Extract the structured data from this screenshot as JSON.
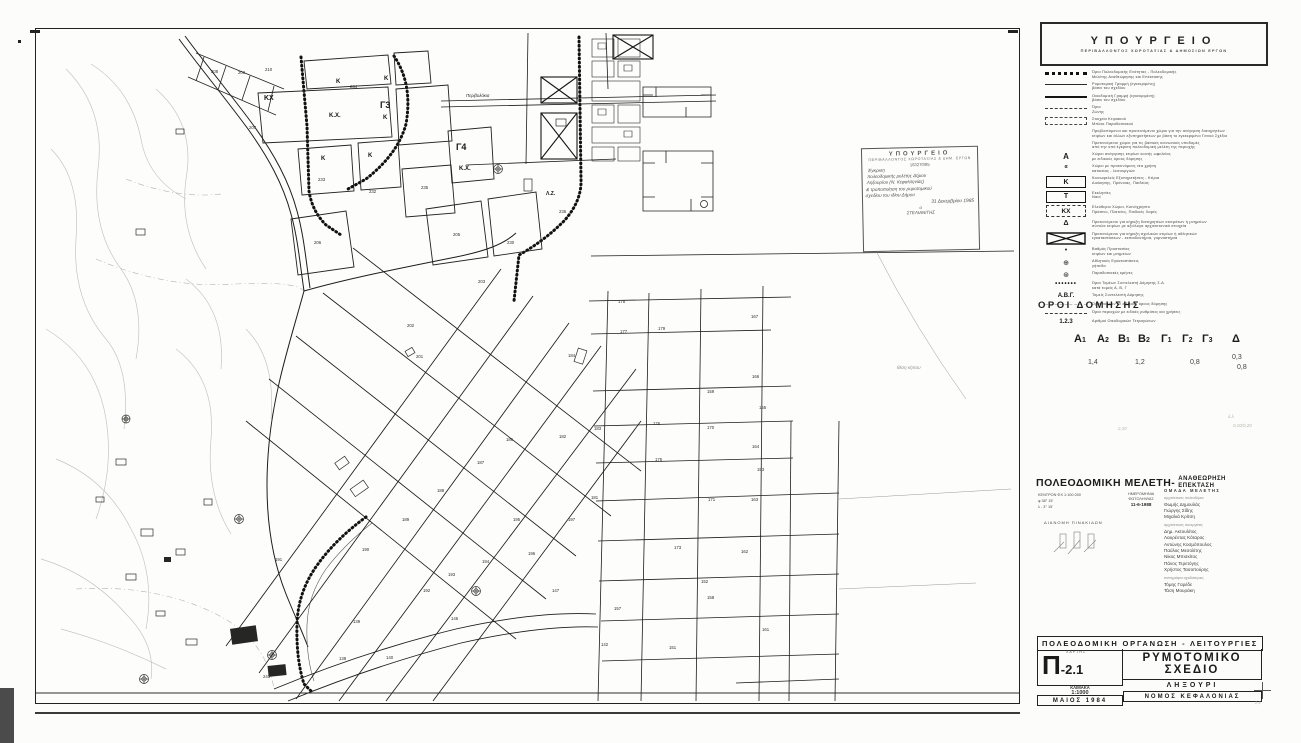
{
  "map": {
    "street_label": "Περιβολάκια",
    "zone_labels": [
      {
        "t": "Κ",
        "x": 300,
        "y": 54,
        "s": 6
      },
      {
        "t": "234",
        "x": 314,
        "y": 59,
        "s": 4.3,
        "n": 1
      },
      {
        "t": "Κ",
        "x": 348,
        "y": 51,
        "s": 6
      },
      {
        "t": "Κ.Χ.",
        "x": 293,
        "y": 88,
        "s": 6
      },
      {
        "t": "ΚΧ",
        "x": 228,
        "y": 71,
        "s": 7
      },
      {
        "t": "Γ3",
        "x": 344,
        "y": 79,
        "s": 9
      },
      {
        "t": "Κ",
        "x": 347,
        "y": 90,
        "s": 6
      },
      {
        "t": "Κ",
        "x": 285,
        "y": 131,
        "s": 6
      },
      {
        "t": "Κ",
        "x": 332,
        "y": 128,
        "s": 6
      },
      {
        "t": "Γ4",
        "x": 420,
        "y": 121,
        "s": 9
      },
      {
        "t": "Κ.Χ.",
        "x": 423,
        "y": 141,
        "s": 6
      },
      {
        "t": "Λ.Ζ.",
        "x": 510,
        "y": 166,
        "s": 5
      }
    ],
    "block_numbers": [
      {
        "n": "208",
        "x": 175,
        "y": 44
      },
      {
        "n": "209",
        "x": 202,
        "y": 45
      },
      {
        "n": "210",
        "x": 229,
        "y": 42
      },
      {
        "n": "207",
        "x": 213,
        "y": 100
      },
      {
        "n": "233",
        "x": 282,
        "y": 152
      },
      {
        "n": "232",
        "x": 333,
        "y": 164
      },
      {
        "n": "235",
        "x": 385,
        "y": 160
      },
      {
        "n": "236",
        "x": 523,
        "y": 184
      },
      {
        "n": "206",
        "x": 278,
        "y": 215
      },
      {
        "n": "205",
        "x": 417,
        "y": 207
      },
      {
        "n": "230",
        "x": 471,
        "y": 215
      },
      {
        "n": "203",
        "x": 442,
        "y": 254
      },
      {
        "n": "202",
        "x": 371,
        "y": 298
      },
      {
        "n": "201",
        "x": 380,
        "y": 329
      },
      {
        "n": "178",
        "x": 582,
        "y": 274
      },
      {
        "n": "177",
        "x": 584,
        "y": 304
      },
      {
        "n": "179",
        "x": 622,
        "y": 301
      },
      {
        "n": "167",
        "x": 715,
        "y": 289
      },
      {
        "n": "166",
        "x": 716,
        "y": 349
      },
      {
        "n": "159",
        "x": 671,
        "y": 364
      },
      {
        "n": "155",
        "x": 723,
        "y": 380
      },
      {
        "n": "176",
        "x": 617,
        "y": 396
      },
      {
        "n": "170",
        "x": 671,
        "y": 400
      },
      {
        "n": "164",
        "x": 716,
        "y": 419
      },
      {
        "n": "175",
        "x": 619,
        "y": 432
      },
      {
        "n": "184",
        "x": 532,
        "y": 328
      },
      {
        "n": "183",
        "x": 558,
        "y": 401
      },
      {
        "n": "182",
        "x": 523,
        "y": 409
      },
      {
        "n": "181",
        "x": 555,
        "y": 470
      },
      {
        "n": "186",
        "x": 470,
        "y": 412
      },
      {
        "n": "187",
        "x": 441,
        "y": 435
      },
      {
        "n": "188",
        "x": 401,
        "y": 463
      },
      {
        "n": "189",
        "x": 366,
        "y": 492
      },
      {
        "n": "190",
        "x": 326,
        "y": 522
      },
      {
        "n": "191",
        "x": 239,
        "y": 532
      },
      {
        "n": "192",
        "x": 387,
        "y": 563
      },
      {
        "n": "193",
        "x": 412,
        "y": 547
      },
      {
        "n": "194",
        "x": 446,
        "y": 534
      },
      {
        "n": "195",
        "x": 477,
        "y": 492
      },
      {
        "n": "196",
        "x": 492,
        "y": 526
      },
      {
        "n": "197",
        "x": 532,
        "y": 492
      },
      {
        "n": "171",
        "x": 672,
        "y": 472
      },
      {
        "n": "163",
        "x": 715,
        "y": 472
      },
      {
        "n": "153",
        "x": 721,
        "y": 442
      },
      {
        "n": "173",
        "x": 638,
        "y": 520
      },
      {
        "n": "162",
        "x": 705,
        "y": 524
      },
      {
        "n": "152",
        "x": 665,
        "y": 554
      },
      {
        "n": "158",
        "x": 671,
        "y": 570
      },
      {
        "n": "151",
        "x": 633,
        "y": 620
      },
      {
        "n": "161",
        "x": 726,
        "y": 602
      },
      {
        "n": "142",
        "x": 565,
        "y": 617
      },
      {
        "n": "147",
        "x": 516,
        "y": 563
      },
      {
        "n": "157",
        "x": 578,
        "y": 581
      },
      {
        "n": "146",
        "x": 415,
        "y": 591
      },
      {
        "n": "139",
        "x": 317,
        "y": 594
      },
      {
        "n": "138",
        "x": 303,
        "y": 631
      },
      {
        "n": "140",
        "x": 350,
        "y": 630
      },
      {
        "n": "243",
        "x": 227,
        "y": 649
      }
    ],
    "stamp": {
      "title": "ΥΠΟΥΡΓΕΙΟ",
      "subtitle": "ΠΕΡΙΒΑΛΛΟΝΤΟΣ ΧΩΡΟΤΑΞΙΑΣ & ΔΗΜ. ΕΡΓΩΝ",
      "number": "163270/85",
      "hand_lines": [
        "Έγκριση",
        "πολεοδομικής μελέτης Δήμου",
        "Ληξουρίου (Ν. Κεφαλληνίας)",
        "& τροποποίηση του ρυμοτομικού",
        "σχεδίου του ιδίου Δήμου"
      ],
      "date_line": "31 Δεκεμβρίου 1985",
      "sig_o": "ο",
      "signature": "ΣΤΕΛΙΑΝΙΤΗΣ",
      "note_below": "θέση κήπου"
    }
  },
  "panel": {
    "ministry": {
      "title": "ΥΠΟΥΡΓΕΙΟ",
      "subtitle": "ΠΕΡΙΒΑΛΛΟΝΤΟΣ  ΧΩΡΟΤΑΞΙΑΣ  &  ΔΗΜΟΣΙΩΝ  ΕΡΓΩΝ"
    },
    "legend": {
      "items": [
        {
          "sym": "bdots",
          "lines": [
            "Όριο Πολεοδομικής Ενότητας - Πολεοδομικής",
            "Μελέτης Αναθεώρησης και Επέκτασης"
          ]
        },
        {
          "sym": "line",
          "lines": [
            "Ρυμοτομική Γραμμή (εγκεκριμένη)",
            "βάσει του σχεδίου"
          ]
        },
        {
          "sym": "thick",
          "lines": [
            "Οικοδομική Γραμμή (εγκεκριμένη)",
            "βάσει του σχεδίου"
          ]
        },
        {
          "sym": "dash",
          "lines": [
            "Όριο",
            "Ζώνης"
          ]
        },
        {
          "sym": "dashbox",
          "lines": [
            "Στοιχεία Κτιριακού",
            "Μπλοκ Παραδοσιακού"
          ]
        },
        {
          "sym": "none",
          "lines": [
            "Προβλεπόμενοι και προτεινόμενοι χώροι για την ανέγερση διατηρητέων",
            "κτιρίων και άλλων εξυπηρετήσεων με βάση το εγκεκριμένο Γενικό Σχέδιο"
          ]
        },
        {
          "sym": "none",
          "lines": [
            "Προτεινόμενοι χώροι για τις βασικές κοινωνικές υποδομές",
            "από την υπό έγκριση πολεοδομική μελέτη της περιοχής"
          ]
        },
        {
          "sym": "A",
          "lines": [
            "Χώροι ανέγερσης κτιρίων κοινής ωφελείας",
            "με ειδικούς όρους δόμησης"
          ]
        },
        {
          "sym": "a",
          "lines": [
            "Χώροι με προτεινόμενη νέα χρήση",
            "κατοικίας - λειτουργιών"
          ]
        },
        {
          "sym": "kbox",
          "k": "Κ",
          "lines": [
            "Κοινωφελείς Εξυπηρετήσεις - Κτίρια",
            "Διοίκησης, Πρόνοιας, Παιδείας"
          ]
        },
        {
          "sym": "tbox",
          "k": "Τ",
          "lines": [
            "Εκκλησίες",
            "Ναοί"
          ]
        },
        {
          "sym": "kxbox",
          "k": "ΚΧ",
          "lines": [
            "Ελεύθεροι Χώροι, Κοινόχρηστο",
            "Πράσινο, Πλατείες, Παιδικές Χαρές"
          ]
        },
        {
          "sym": "tri",
          "lines": [
            "Προτεινόμενοι για κήρυξη διατηρητέων κτισμάτων ή μνημείων",
            "σύνολα κτιρίων με αξιόλογα αρχιτεκτονικά στοιχεία"
          ]
        },
        {
          "sym": "xbox",
          "lines": [
            "Προτεινόμενοι για κήρυξη σχολικών κτιρίων ή αθλητικών",
            "εγκαταστάσεων - εκπαιδευτήρια, γυμναστήρια"
          ]
        },
        {
          "sym": "dot",
          "lines": [
            "Βαθμός Προστασίας",
            "κτιρίων και μνημείων"
          ]
        },
        {
          "sym": "circplus",
          "lines": [
            "Αθλητικές Εγκαταστάσεις",
            "γήπεδα"
          ]
        },
        {
          "sym": "circast",
          "lines": [
            "Παραδοσιακές κρήνες"
          ]
        },
        {
          "sym": "dotrow",
          "lines": [
            "Όρια Τομέων Συντελεστή Δόμησης Σ.Δ.",
            "κατά τομείς Α, Β, Γ"
          ]
        },
        {
          "sym": "abc",
          "k": "Α.Β.Γ.",
          "lines": [
            "Τομείς Συντελεστή Δόμησης"
          ]
        },
        {
          "sym": "faintdash",
          "lines": [
            "Όρια τομέων με ειδικούς όρους δόμησης"
          ]
        },
        {
          "sym": "dashrow",
          "lines": [
            "Όρια περιοχών με ειδικές ρυθμίσεις και χρήσεις"
          ]
        },
        {
          "sym": "nums",
          "k": "1.2.3",
          "lines": [
            "Αριθμοί Οικοδομικών Τετραγώνων"
          ]
        }
      ]
    },
    "building_terms": {
      "title": "ΟΡΟΙ ΔΟΜΗΣΗΣ",
      "columns": [
        "Α1",
        "Α2",
        "Β1",
        "Β2",
        "Γ1",
        "Γ2",
        "Γ3",
        "Δ"
      ],
      "col_x": [
        36,
        59,
        80,
        100,
        123,
        144,
        164,
        194
      ],
      "values": [
        {
          "v": "1,4",
          "x": 50,
          "y": 48
        },
        {
          "v": "1,2",
          "x": 97,
          "y": 48
        },
        {
          "v": "0,8",
          "x": 152,
          "y": 48
        },
        {
          "v": "0,3",
          "x": 194,
          "y": 43
        },
        {
          "v": "0,8",
          "x": 199,
          "y": 53
        }
      ],
      "pencil_notes": [
        {
          "v": "2,20",
          "x": 80,
          "y": 115
        },
        {
          "v": "0,20/0,20",
          "x": 195,
          "y": 112
        },
        {
          "v": "λ.λ.",
          "x": 190,
          "y": 103
        }
      ]
    },
    "study": {
      "title_left": "ΠΟΛΕΟΔΟΜΙΚΗ ΜΕΛΕΤΗ-",
      "title_right_1": "ΑΝΑΘΕΩΡΗΣΗ",
      "title_right_2": "ΕΠΕΚΤΑΣΗ",
      "meta": [
        "ΚΕΝΤΡΟΝ ΦΧ 1:100.000",
        "φ   38° 15'",
        "λ   - 3° 15'"
      ],
      "photo_1": "ΗΜΕΡΟΜΗΝΙΑ",
      "photo_2": "ΦΩΤΟΛΗΨΙΑΣ",
      "photo_date": "11-6-1988",
      "plates_title": "ΔΙΑΝΟΜΗ  ΠΙΝΑΚΙΔΩΝ",
      "team_title": "ΟΜΑΔΑ  ΜΕΛΕΤΗΣ",
      "groups": [
        {
          "header": "αρχιτέκτονες πολεοδόμοι",
          "names": [
            "Θωμής Δημουλάς",
            "Γιώργης Σίδης",
            "Μιχαλιά Κρίτση"
          ]
        },
        {
          "header": "αρχιτέκτονες συνεργάτες",
          "names": [
            "Δημ. Ακτουλίτος",
            "Λαυρέντας Κόταρος",
            "Αντώνης Κοσμόπουλος",
            "Παύλος Μεσολίτης",
            "Νίκος Μπισκίτος",
            "Πάνος Τερετόγης",
            "Χρήστος Τασοπούρης"
          ]
        },
        {
          "header": "τοπογράφοι σχεδιάστριες",
          "names": [
            "Τόμης Γαρέδε",
            "Τάση Μουράκη"
          ]
        }
      ]
    },
    "titleblock": {
      "header": "ΠΟΛΕΟΔΟΜΙΚΗ  ΟΡΓΑΝΩΣΗ  -  ΛΕΙΤΟΥΡΓΙΕΣ",
      "chart_label": "ΧΑΡΤΗΣ",
      "code_big": "Π",
      "code_small": "-2.1",
      "scale_label": "ΚΛΙΜΑΚΑ",
      "scale": "1:1000",
      "date": "ΜΑΙΟΣ 1984",
      "title_1": "ΡΥΜΟΤΟΜΙΚΟ",
      "title_2": "ΣΧΕΔΙΟ",
      "place": "ΛΗΞΟΥΡΙ",
      "region": "ΝΟΜΟΣ  ΚΕΦΑΛΟΝΙΑΣ",
      "reg_scribble": "2,5"
    }
  }
}
